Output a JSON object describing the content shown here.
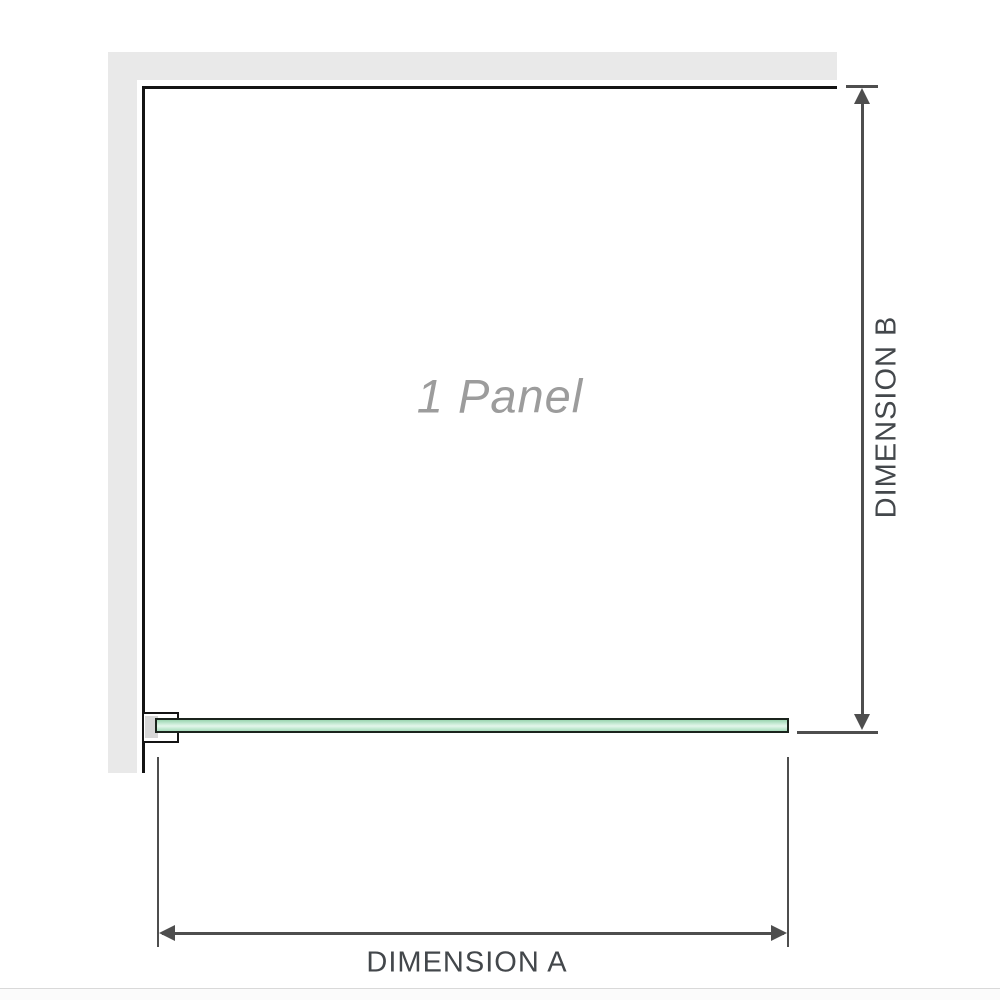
{
  "labels": {
    "panel": "1 Panel",
    "dimension_a": "DIMENSION A",
    "dimension_b": "DIMENSION B"
  },
  "icons": {
    "dimension_b_top": "arrow-up-icon",
    "dimension_b_bottom": "arrow-down-icon",
    "dimension_a_left": "arrow-left-icon",
    "dimension_a_right": "arrow-right-icon"
  },
  "colors": {
    "background": "#ffffff",
    "wall": "#e9e9e9",
    "outline": "#141414",
    "dimension_line": "#4e4e4e",
    "dimension_text": "#43474b",
    "panel_text": "#9c9c9c",
    "glass_border": "#1b241d",
    "glass_fill": "#a8dcbc",
    "glass_fill_light": "#e4f6eb",
    "bracket_fill": "#ffffff",
    "bracket_inner": "#d7d7d7",
    "divider": "#d9d9d9"
  }
}
